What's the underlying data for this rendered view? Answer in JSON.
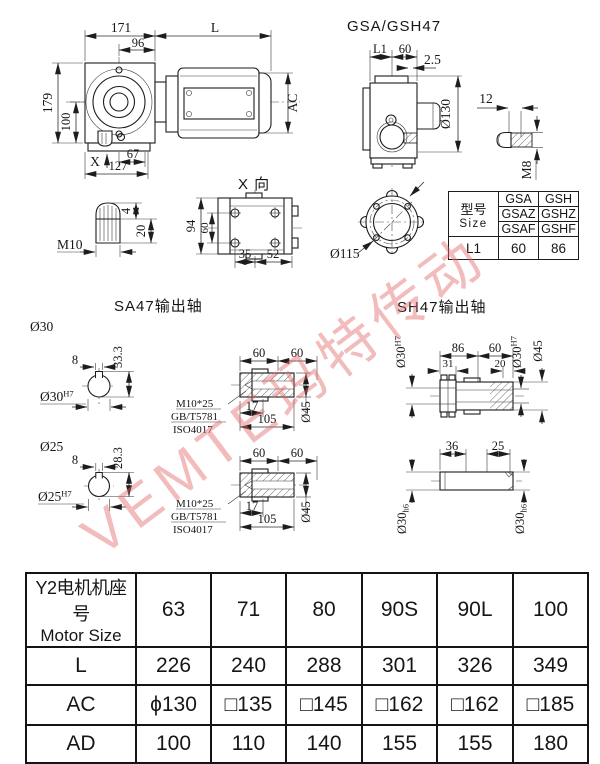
{
  "watermark": {
    "text": "VEMTE玛特传动",
    "color": "#e26b6b"
  },
  "front_view": {
    "d171": "171",
    "dL": "L",
    "d96": "96",
    "d179": "179",
    "d100": "100",
    "dAC": "AC",
    "dX": "X",
    "d67": "67",
    "d127": "127"
  },
  "side_view": {
    "title": "GSA/GSH47",
    "dL1": "L1",
    "d60": "60",
    "d2_5": "2.5",
    "d130": "Ø130",
    "d12": "12",
    "dM8": "M8"
  },
  "m10_detail": {
    "dM10": "M10",
    "d4": "4",
    "d20": "20"
  },
  "x_view": {
    "label": "X 向",
    "d94": "94",
    "d60": "60",
    "d35": "35",
    "d52": "52"
  },
  "flange_view": {
    "d115": "Ø115"
  },
  "size_table": {
    "header_cn": "型号",
    "header_en": "Size",
    "rows": [
      [
        "GSA",
        "GSH"
      ],
      [
        "GSAZ",
        "GSHZ"
      ],
      [
        "GSAF",
        "GSHF"
      ]
    ],
    "l1": [
      "L1",
      "60",
      "86"
    ]
  },
  "sa47": {
    "title": "SA47输出轴",
    "s30": {
      "label": "Ø30",
      "d8": "8",
      "dh": "33.3",
      "bore": "Ø30",
      "bore_sup": "H7"
    },
    "s25": {
      "label": "Ø25",
      "d8": "8",
      "dh": "28.3",
      "bore": "Ø25",
      "bore_sup": "H7"
    },
    "shaft": {
      "d60a": "60",
      "d60b": "60",
      "d17": "17",
      "d105": "105",
      "d45": "Ø45",
      "leader1": "M10*25",
      "leader2": "GB/T5781",
      "leader3": "ISO4017"
    }
  },
  "sh47": {
    "title": "SH47输出轴",
    "upper": {
      "d86": "86",
      "d60": "60",
      "d31": "31",
      "d20": "20",
      "boreL": "Ø30",
      "boreL_sup": "H7",
      "boreR": "Ø30",
      "boreR_sup": "H7",
      "d45": "Ø45"
    },
    "lower": {
      "d36": "36",
      "d25": "25",
      "diaL": "Ø30",
      "diaL_sub": "h6",
      "diaR": "Ø30",
      "diaR_sub": "h6"
    }
  },
  "motor_table": {
    "header_cn": "Y2电机机座号",
    "header_en": "Motor Size",
    "sizes": [
      "63",
      "71",
      "80",
      "90S",
      "90L",
      "100"
    ],
    "rows": [
      {
        "label": "L",
        "values": [
          "226",
          "240",
          "288",
          "301",
          "326",
          "349"
        ]
      },
      {
        "label": "AC",
        "values": [
          "ϕ130",
          "□135",
          "□145",
          "□162",
          "□162",
          "□185"
        ]
      },
      {
        "label": "AD",
        "values": [
          "100",
          "110",
          "140",
          "155",
          "155",
          "180"
        ]
      }
    ]
  }
}
